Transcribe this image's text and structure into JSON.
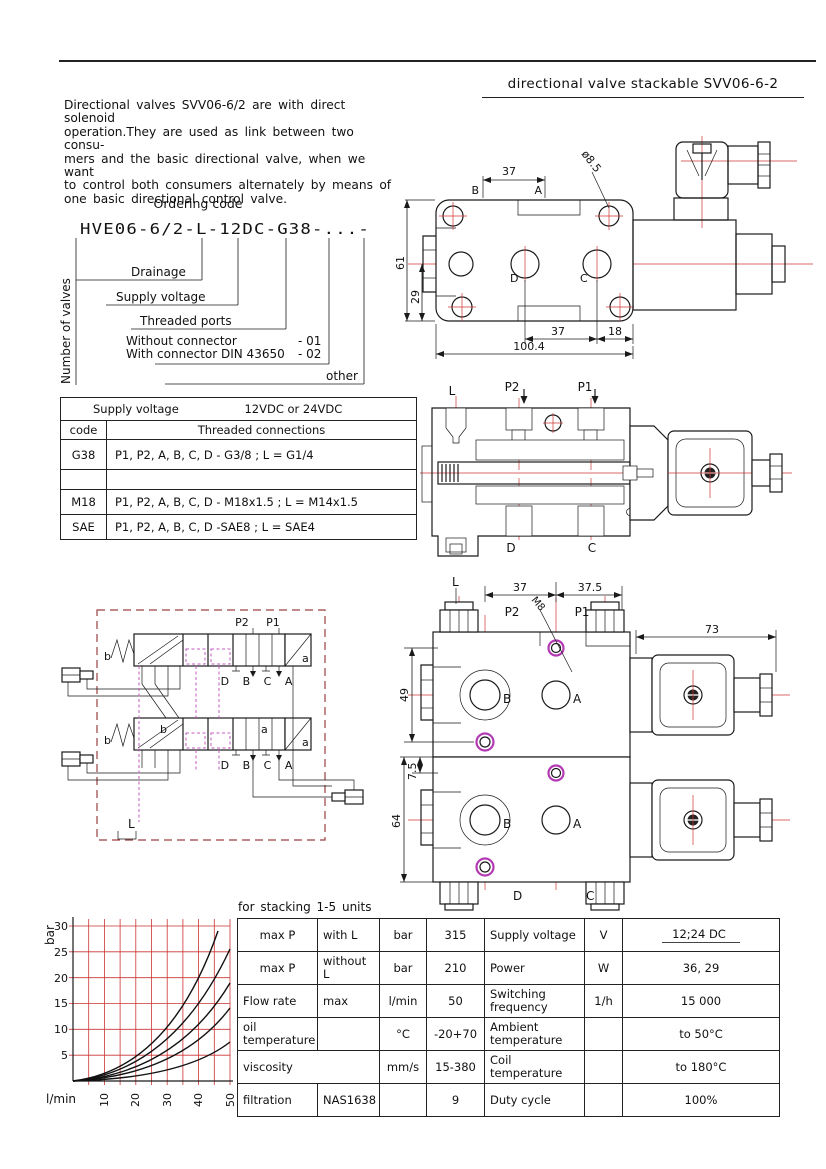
{
  "header": {
    "title": "directional valve stackable SVV06-6-2"
  },
  "intro": {
    "lines": [
      "Directional valves SVV06-6/2 are with direct solenoid",
      "operation.They are used as link between two consu-",
      "mers and the basic directional valve, when we want",
      "to control both consumers alternately by means of",
      "one basic directional control valve."
    ]
  },
  "ordering": {
    "title": "Ordering code",
    "code": "HVE06-6/2-L-12DC-G38-...-",
    "number_of_valves": "Number of valves",
    "drainage": "Drainage",
    "supply_voltage": "Supply voltage",
    "threaded_ports": "Threaded ports",
    "without_connector": "Without connector",
    "without_code": "-  01",
    "with_connector": "With connector DIN 43650",
    "with_code": "-  02",
    "other": "other"
  },
  "voltage_table": {
    "supply_voltage_label": "Supply voltage",
    "supply_voltage_value": "12VDC or 24VDC",
    "code_header": "code",
    "connections_header": "Threaded connections",
    "rows": [
      {
        "code": "G38",
        "connections": "P1, P2, A, B, C, D - G3/8 ; L = G1/4"
      },
      {
        "code": "",
        "connections": ""
      },
      {
        "code": "M18",
        "connections": "P1, P2, A, B, C, D - M18x1.5 ; L = M14x1.5"
      },
      {
        "code": "SAE",
        "connections": "P1, P2, A, B, C, D -SAE8 ; L = SAE4"
      }
    ]
  },
  "drawing_top": {
    "dim_37_top": "37",
    "dia_8_5": "ø8.5",
    "port_b": "B",
    "port_a": "A",
    "dim_61": "61",
    "dim_29": "29",
    "port_d": "D",
    "port_c": "C",
    "dim_37_bottom": "37",
    "dim_18": "18",
    "dim_100_4": "100.4"
  },
  "drawing_section": {
    "port_l": "L",
    "port_p2": "P2",
    "port_p1": "P1",
    "port_d": "D",
    "port_c": "C"
  },
  "schematic": {
    "p2": "P2",
    "p1": "P1",
    "spring_b_1": "b",
    "sol_a_1": "a",
    "ports_1": "D B C A",
    "spring_b_2": "b",
    "pos_b_2": "b",
    "pos_a_2": "a",
    "sol_a_2": "a",
    "ports_2": "D B C A",
    "drain_l": "L"
  },
  "drawing_stack": {
    "port_l": "L",
    "dim_37": "37",
    "dim_37_5": "37.5",
    "port_p2": "P2",
    "thread_m8": "M8",
    "port_p1": "P1",
    "dim_73": "73",
    "dim_49": "49",
    "dim_7_5": "7.5",
    "dim_64": "64",
    "port_b1": "B",
    "port_a1": "A",
    "port_b2": "B",
    "port_a2": "A",
    "port_d": "D",
    "port_c": "C"
  },
  "chart": {
    "ylabel": "bar",
    "xlabel": "l/min",
    "yticks": [
      "30",
      "25",
      "20",
      "15",
      "10",
      "5"
    ],
    "xticks": [
      "10",
      "20",
      "30",
      "40",
      "50"
    ]
  },
  "chart_data": {
    "type": "line",
    "title": "Pressure drop vs flow (5 curves)",
    "xlabel": "l/min",
    "ylabel": "bar",
    "xlim": [
      0,
      50
    ],
    "ylim": [
      0,
      32
    ],
    "grid": true,
    "grid_color": "#cc3333",
    "legend": false,
    "x": [
      0,
      10,
      20,
      30,
      40,
      46,
      50
    ],
    "series": [
      {
        "name": "curve1",
        "values": [
          0,
          1.4,
          5.7,
          12.8,
          22.7,
          30,
          null
        ]
      },
      {
        "name": "curve2",
        "values": [
          0,
          1.0,
          4.2,
          9.4,
          16.6,
          22,
          26
        ]
      },
      {
        "name": "curve3",
        "values": [
          0,
          0.8,
          3.0,
          6.8,
          12.2,
          16,
          19
        ]
      },
      {
        "name": "curve4",
        "values": [
          0,
          0.6,
          2.2,
          5.0,
          9.0,
          11.8,
          14
        ]
      },
      {
        "name": "curve5",
        "values": [
          0,
          0.3,
          1.2,
          2.7,
          4.8,
          6.3,
          7.5
        ]
      }
    ]
  },
  "specs": {
    "title": "for stacking 1-5 units",
    "rows": [
      [
        "max P",
        "with L",
        "bar",
        "315",
        "Supply voltage",
        "V",
        "12;24 DC"
      ],
      [
        "max P",
        "without L",
        "bar",
        "210",
        "Power",
        "W",
        "36, 29"
      ],
      [
        "Flow rate",
        "max",
        "l/min",
        "50",
        "Switching frequency",
        "1/h",
        "15 000"
      ],
      [
        "oil temperature",
        "",
        "°C",
        "-20+70",
        "Ambient temperature",
        "",
        "to 50°C"
      ],
      [
        "viscosity",
        "",
        "mm/s",
        "15-380",
        "Coil temperature",
        "",
        "to 180°C"
      ],
      [
        "filtration",
        "NAS1638",
        "",
        "9",
        "Duty cycle",
        "",
        "100%"
      ]
    ]
  }
}
